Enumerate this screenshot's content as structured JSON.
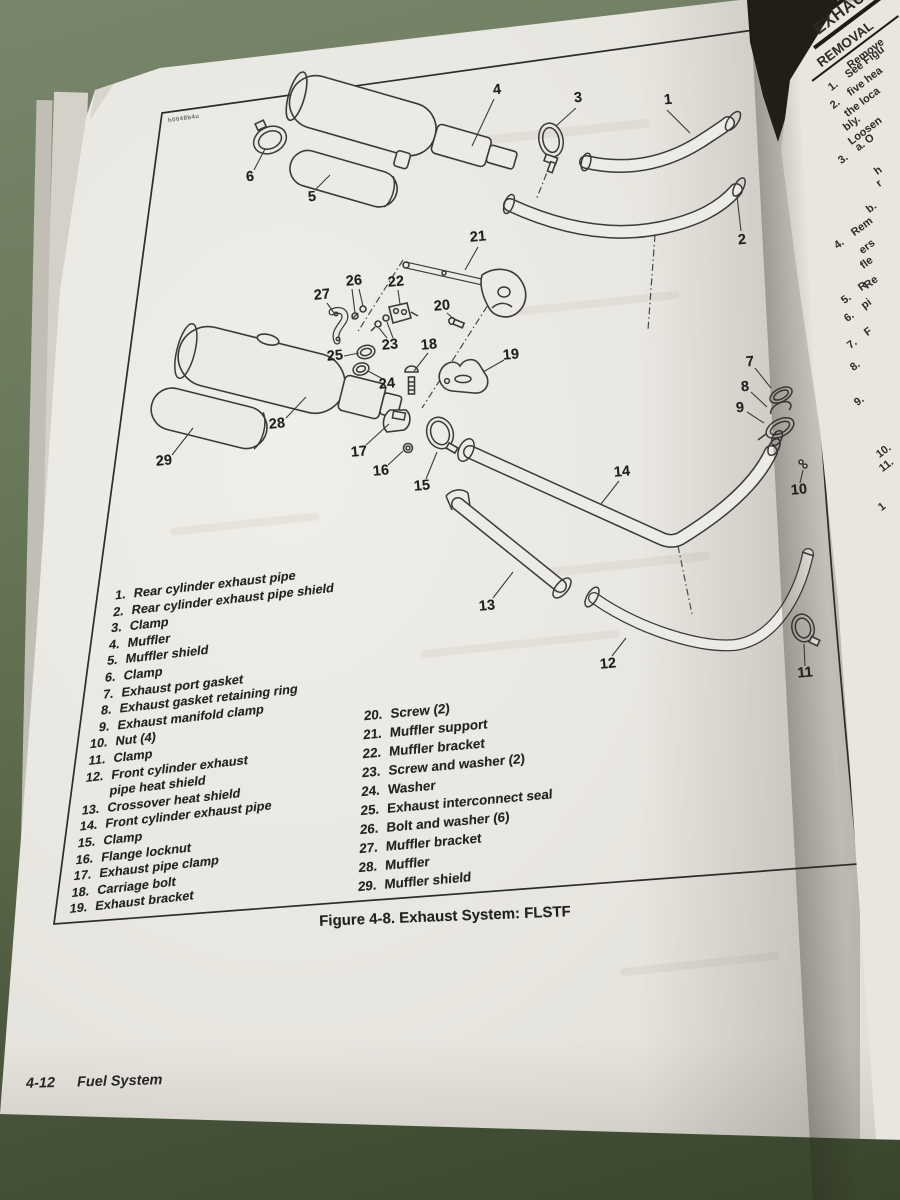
{
  "figure": {
    "caption": "Figure 4-8. Exhaust System: FLSTF",
    "art_code": "h0048b4u",
    "callouts": [
      "1",
      "2",
      "3",
      "4",
      "5",
      "6",
      "7",
      "8",
      "9",
      "10",
      "11",
      "12",
      "13",
      "14",
      "15",
      "16",
      "17",
      "18",
      "19",
      "20",
      "21",
      "22",
      "23",
      "24",
      "25",
      "26",
      "27",
      "28",
      "29"
    ]
  },
  "parts_list": {
    "left": [
      {
        "num": "1.",
        "label": "Rear cylinder exhaust pipe"
      },
      {
        "num": "2.",
        "label": "Rear cylinder exhaust pipe shield"
      },
      {
        "num": "3.",
        "label": "Clamp"
      },
      {
        "num": "4.",
        "label": "Muffler"
      },
      {
        "num": "5.",
        "label": "Muffler shield"
      },
      {
        "num": "6.",
        "label": "Clamp"
      },
      {
        "num": "7.",
        "label": "Exhaust port gasket"
      },
      {
        "num": "8.",
        "label": "Exhaust gasket retaining ring"
      },
      {
        "num": "9.",
        "label": "Exhaust manifold clamp"
      },
      {
        "num": "10.",
        "label": "Nut (4)"
      },
      {
        "num": "11.",
        "label": "Clamp"
      },
      {
        "num": "12.",
        "label": "Front cylinder exhaust"
      },
      {
        "num": "",
        "label": "pipe heat shield"
      },
      {
        "num": "13.",
        "label": "Crossover heat shield"
      },
      {
        "num": "14.",
        "label": "Front cylinder exhaust pipe"
      },
      {
        "num": "15.",
        "label": "Clamp"
      },
      {
        "num": "16.",
        "label": "Flange locknut"
      },
      {
        "num": "17.",
        "label": "Exhaust pipe clamp"
      },
      {
        "num": "18.",
        "label": "Carriage bolt"
      },
      {
        "num": "19.",
        "label": "Exhaust bracket"
      }
    ],
    "right": [
      {
        "num": "20.",
        "label": "Screw (2)"
      },
      {
        "num": "21.",
        "label": "Muffler support"
      },
      {
        "num": "22.",
        "label": "Muffler bracket"
      },
      {
        "num": "23.",
        "label": "Screw and washer (2)"
      },
      {
        "num": "24.",
        "label": "Washer"
      },
      {
        "num": "25.",
        "label": "Exhaust interconnect seal"
      },
      {
        "num": "26.",
        "label": "Bolt and washer (6)"
      },
      {
        "num": "27.",
        "label": "Muffler bracket"
      },
      {
        "num": "28.",
        "label": "Muffler"
      },
      {
        "num": "29.",
        "label": "Muffler shield"
      }
    ]
  },
  "footer": {
    "page_number": "4-12",
    "section": "Fuel System"
  },
  "right_page": {
    "heading": "EXHAUST",
    "subheading": "REMOVAL",
    "lines": [
      {
        "num": "",
        "text": "Remove"
      },
      {
        "num": "1.",
        "text": "See Figu"
      },
      {
        "num": "2.",
        "text": "five hea"
      },
      {
        "num": "",
        "text": "the loca"
      },
      {
        "num": "",
        "text": "bly."
      },
      {
        "num": "",
        "text": "Loosen"
      },
      {
        "num": "3.",
        "text": "a.  O"
      },
      {
        "num": "",
        "text": "h"
      },
      {
        "num": "",
        "text": "r"
      },
      {
        "num": "",
        "text": "b."
      },
      {
        "num": "4.",
        "text": "Rem"
      },
      {
        "num": "",
        "text": "ers"
      },
      {
        "num": "",
        "text": "fle"
      },
      {
        "num": "",
        "text": "Re"
      },
      {
        "num": "5.",
        "text": "R"
      },
      {
        "num": "6.",
        "text": "pi"
      },
      {
        "num": "7.",
        "text": "F"
      },
      {
        "num": "8.",
        "text": ""
      },
      {
        "num": "9.",
        "text": ""
      },
      {
        "num": "10.",
        "text": ""
      },
      {
        "num": "11.",
        "text": ""
      },
      {
        "num": "1",
        "text": ""
      }
    ]
  },
  "colors": {
    "background_green": "#6b7a5c",
    "page": "#e9e7e1",
    "ink": "#262626"
  }
}
